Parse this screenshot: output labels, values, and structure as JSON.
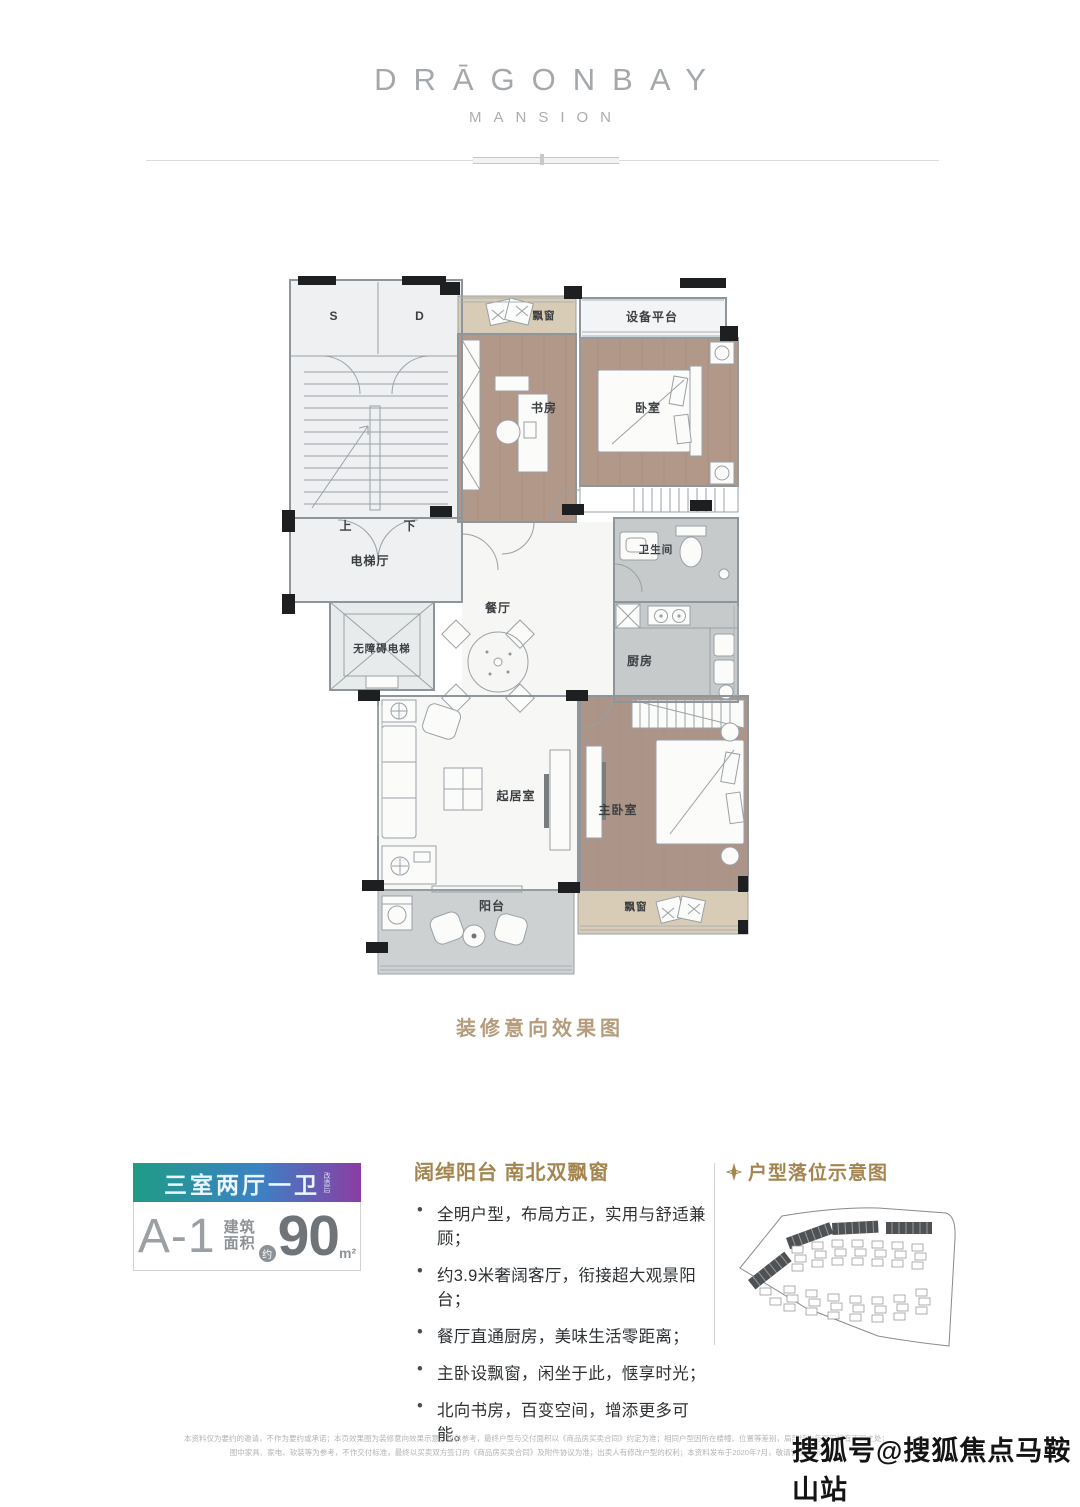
{
  "brand": {
    "title": "DRĀGONBAY",
    "subtitle": "MANSION"
  },
  "plan": {
    "caption": "装修意向效果图",
    "rooms": {
      "stair_s": "S",
      "stair_d": "D",
      "up": "上",
      "down": "下",
      "bay_window_top": "飘窗",
      "equipment_platform": "设备平台",
      "study": "书房",
      "bedroom": "卧室",
      "elevator_hall": "电梯厅",
      "accessible_elevator": "无障碍电梯",
      "dining": "餐厅",
      "bathroom": "卫生间",
      "kitchen": "厨房",
      "living": "起居室",
      "master_bedroom": "主卧室",
      "balcony": "阳台",
      "bay_window_bottom": "飘窗"
    }
  },
  "badge": {
    "layout": "三室两厅一卫",
    "layout_note": "改造后",
    "unit": "A-1",
    "area_word_top": "建筑",
    "area_word_bottom": "面积",
    "approx": "约",
    "area_value": "90",
    "area_unit": "m²",
    "gradient": [
      "#1f9c85",
      "#3b82c4",
      "#8b3da4"
    ]
  },
  "features": {
    "title": "阔绰阳台 南北双飘窗",
    "items": [
      "全明户型，布局方正，实用与舒适兼顾；",
      "约3.9米奢阔客厅，衔接超大观景阳台；",
      "餐厅直通厨房，美味生活零距离；",
      "主卧设飘窗，闲坐于此，惬享时光；",
      "北向书房，百变空间，增添更多可能。"
    ]
  },
  "siteplan": {
    "title": "户型落位示意图"
  },
  "footer": {
    "disclaimer_line1": "本资料仅为要约的邀请，不作为要约或承诺；本页效果图为装修意向效果示意，仅供参考，最终户型与交付面积以《商品房买卖合同》约定为准；相同户型因所在楼幢、位置等差别，局部结构与面积将有不同之处；",
    "disclaimer_line2": "图中家具、家电、软装等为参考，不作交付标准，最终以买卖双方签订的《商品房买卖合同》及附件协议为准；出卖人有修改户型的权利；本资料发布于2020年7月，敬请留意最新资料。",
    "watermark": "搜狐号@搜狐焦点马鞍山站"
  },
  "colors": {
    "accent_gold": "#a5854f",
    "caption": "#b59c7c",
    "wood_floor": "#b19889",
    "tile": "#c7cacb",
    "bay_window": "#d9ccb6"
  }
}
